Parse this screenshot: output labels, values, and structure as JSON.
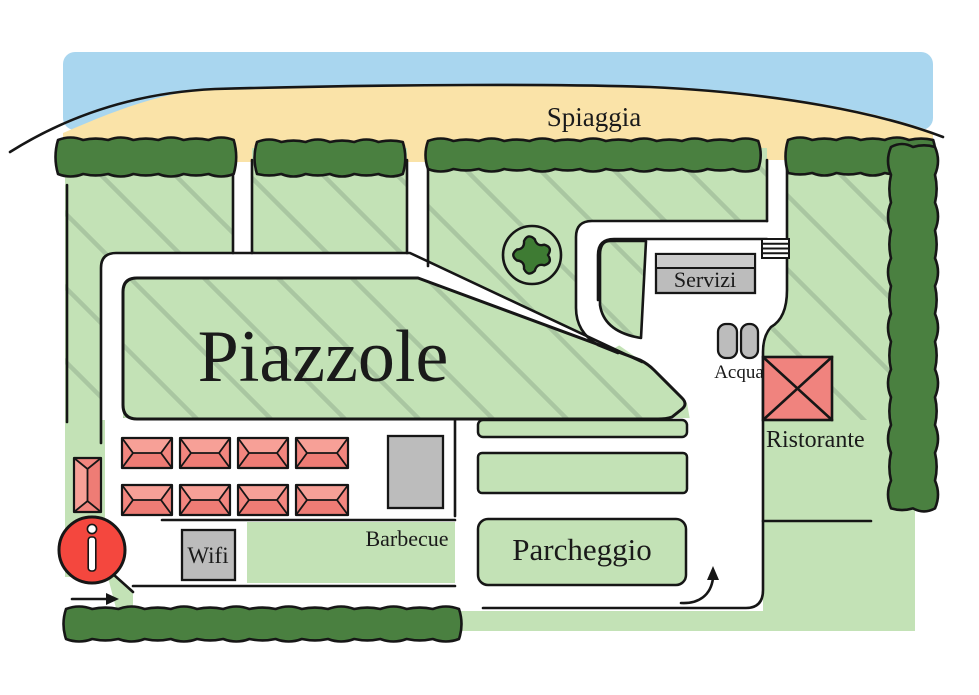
{
  "map": {
    "region_labels": {
      "spiaggia": "Spiaggia",
      "piazzole": "Piazzole",
      "servizi": "Servizi",
      "acqua": "Acqua",
      "ristorante": "Ristorante",
      "barbecue": "Barbecue",
      "parcheggio": "Parcheggio",
      "wifi": "Wifi"
    },
    "icons": {
      "info": "info-point-icon",
      "tree": "tree-icon",
      "steps": "beach-steps-icon",
      "entrance_arrow": "entrance-arrow-icon",
      "turn_arrow": "turn-arrow-icon",
      "tent": "tent-icon",
      "hedge": "hedge-icon"
    },
    "colors": {
      "sea": "#a9d6ef",
      "sand": "#fae3a8",
      "grass": "#c3e2b6",
      "grass_hatch": "#a9c6a1",
      "hedge": "#4a8040",
      "tree": "#3e7b33",
      "building_gray": "#bcbcbc",
      "building_roof_gray": "#cacaca",
      "tent_red": "#f2867f",
      "tent_red_light": "#f7a097",
      "tent_red_dark": "#ee7c75",
      "restaurant_red": "#f0837e",
      "info_red": "#f4473e",
      "outline": "#161616"
    }
  }
}
